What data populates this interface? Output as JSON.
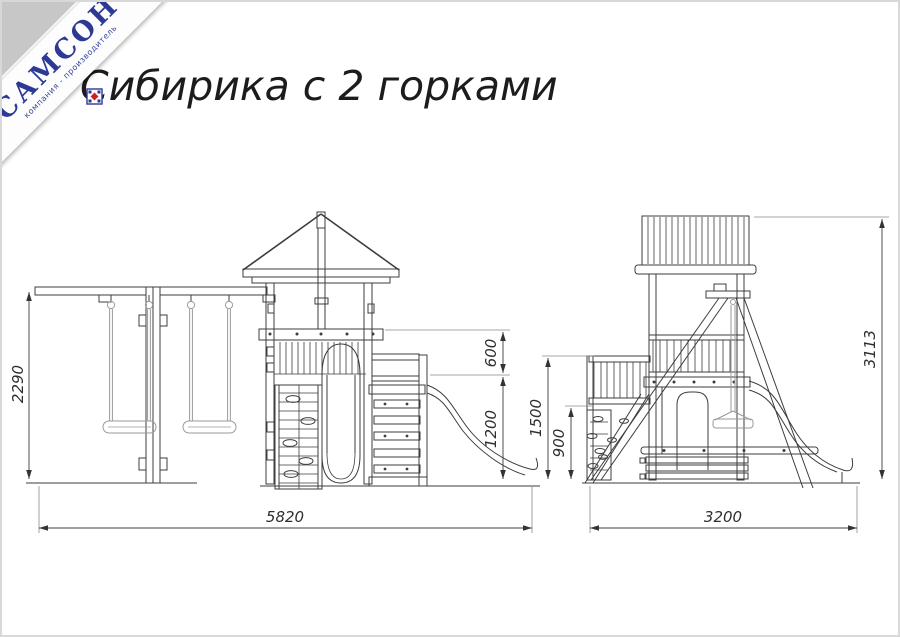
{
  "logo": {
    "brand": "САМСОН",
    "tagline": "компания - производитель",
    "brand_color": "#2c3a96",
    "emblem_red": "#cf2027",
    "corner_grey": "#c7c7c7"
  },
  "title": {
    "text": "Сибирика с 2 горками",
    "color": "#1c1c1c"
  },
  "drawing": {
    "line_color": "#3d3d3d",
    "accessory_color": "#9a9a9a",
    "dims": {
      "front": {
        "overall_height": "2290",
        "rail_height": "600",
        "slide_platform_height": "1200",
        "overall_width": "5820"
      },
      "side": {
        "deck_height": "1500",
        "wall_height": "900",
        "overall_height": "3113",
        "overall_width": "3200"
      }
    }
  }
}
